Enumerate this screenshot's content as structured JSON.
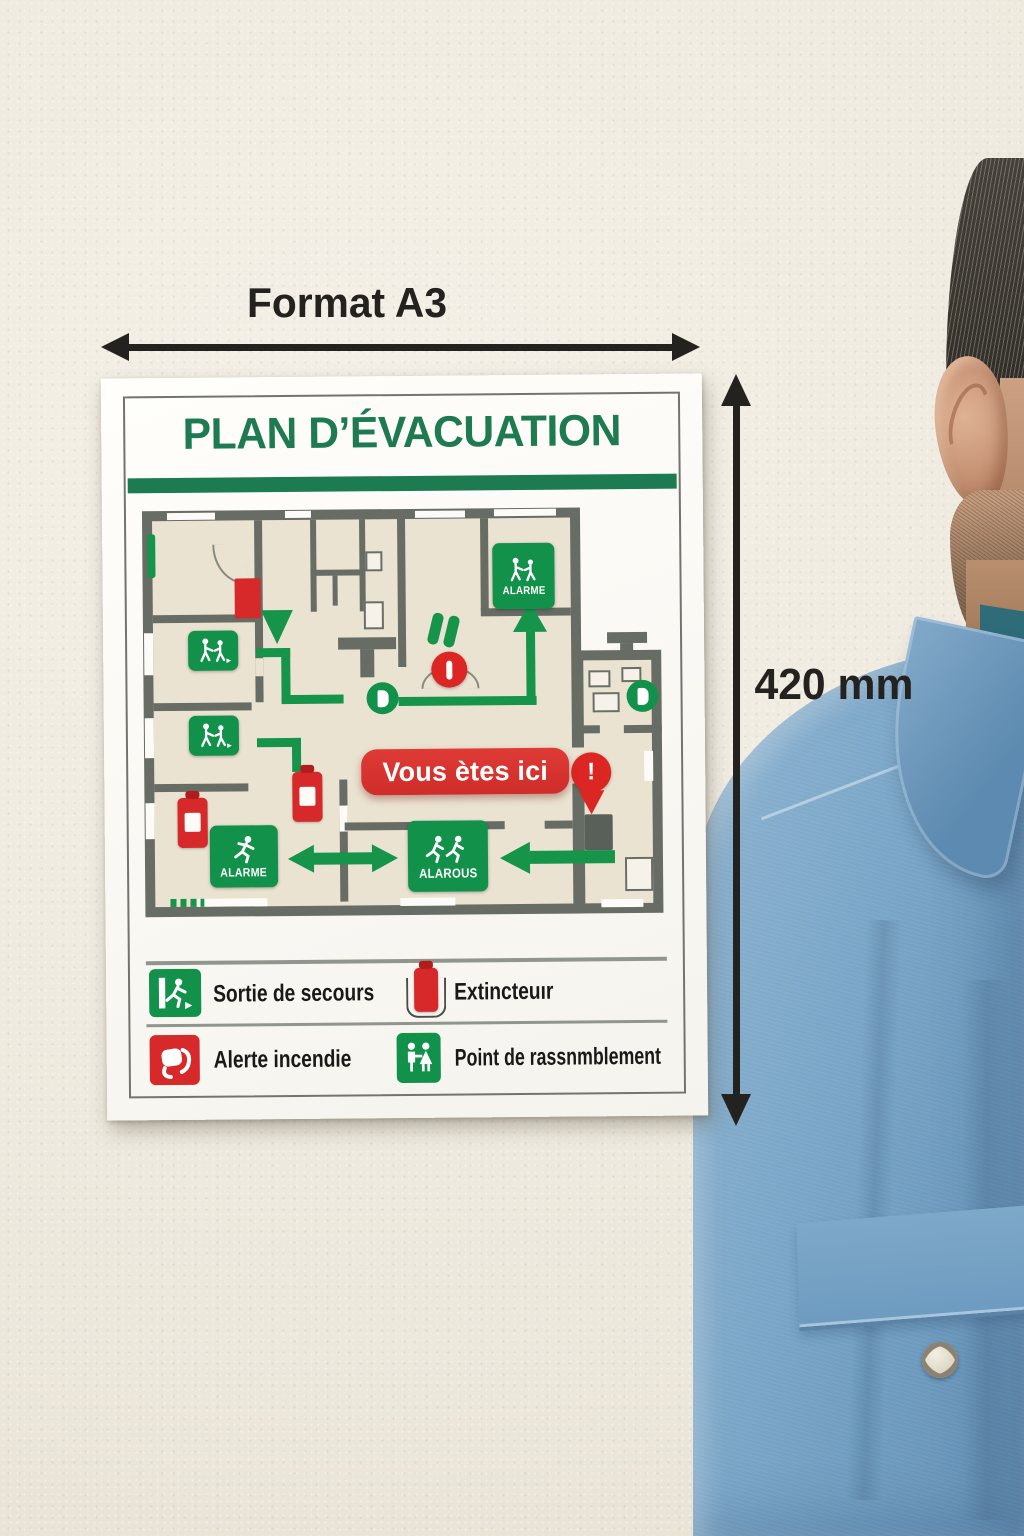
{
  "dimensions": {
    "width_label": "Format A3",
    "height_label": "420 mm"
  },
  "poster": {
    "title": "PLAN D’ÉVACUATION",
    "plan_labels": {
      "top_exit_sign": "ALARME",
      "you_are_here": "Vous ètes ici",
      "bottom_left_sign": "ALARME",
      "bottom_center_sign": "ALAROUS"
    },
    "legend": [
      {
        "icon": "emergency-exit-icon",
        "label": "Sortie de secours"
      },
      {
        "icon": "extinguisher-icon",
        "label": "Extincteuır"
      },
      {
        "icon": "fire-alert-icon",
        "label": "Alerte incendie"
      },
      {
        "icon": "assembly-point-icon",
        "label": "Point de rassnmblement"
      }
    ]
  },
  "colors": {
    "sign_green": "#12914a",
    "title_green": "#1e7a50",
    "alert_red": "#d7282a",
    "plan_floor": "#eae3d1",
    "plan_wall": "#676c64",
    "annotation_black": "#23221f",
    "denim_blue": "#7aa5c6"
  }
}
